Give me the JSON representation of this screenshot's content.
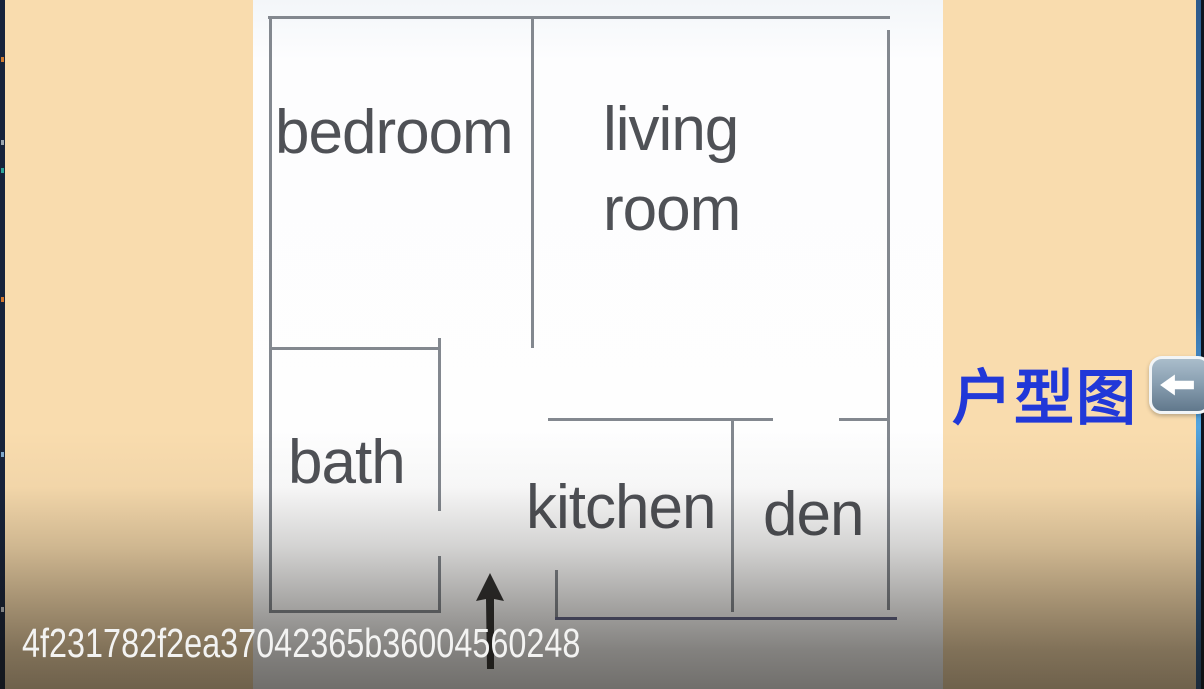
{
  "frame": {
    "type": "video-frame-floor-plan"
  },
  "floor_plan": {
    "labels": {
      "bedroom": "bedroom",
      "living_1": "living",
      "living_2": "room",
      "bath": "bath",
      "kitchen": "kitchen",
      "den": "den"
    },
    "rooms": [
      "bedroom",
      "living room",
      "bath",
      "kitchen",
      "den"
    ],
    "entrance_icon": "up-arrow"
  },
  "caption": {
    "text": "户型图",
    "color": "#2138d8"
  },
  "back_button": {
    "icon": "left-arrow"
  },
  "watermark": {
    "text": "4f231782f2ea37042365b36004560248",
    "color": "#f3f3f2"
  },
  "colors": {
    "background": "#f9dcae",
    "sheet": "#fdfdfe",
    "wall": "#83888f",
    "wall_accent": "#606489",
    "room_label": "#4f5156",
    "caption_blue": "#2138d8",
    "button_face": "#8aa0b2",
    "button_border": "#f2f5f7",
    "edge_blue": "#356fa9",
    "edge_dark": "#0d1420"
  }
}
